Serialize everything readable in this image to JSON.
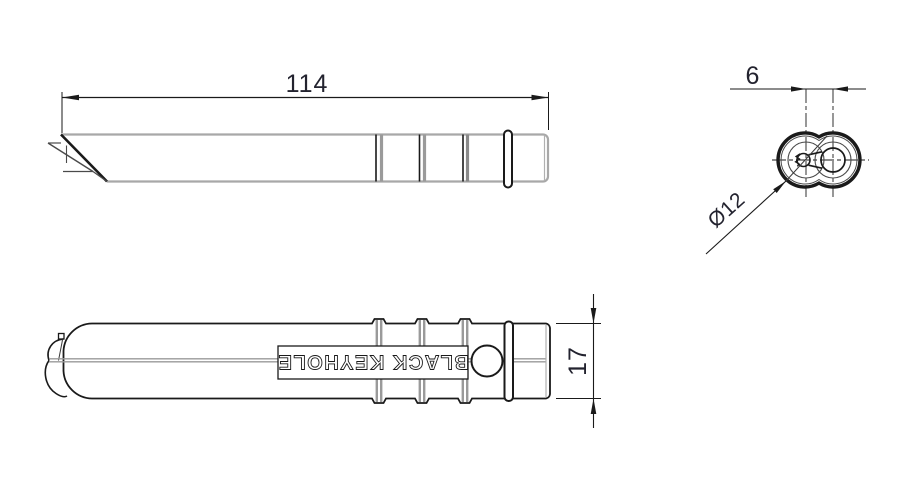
{
  "part_label": "BLACK KEYHOLE",
  "dimensions": {
    "overall_length": "114",
    "lobe_center_spacing": "6",
    "lobe_diameter": "Ø12",
    "body_width": "17"
  },
  "colors": {
    "background": "#ffffff",
    "dark_line": "#1a1a1a",
    "gray_line": "#a8a8a8",
    "rib_gray": "#9a9a9a",
    "dimension_text": "#23232f"
  }
}
